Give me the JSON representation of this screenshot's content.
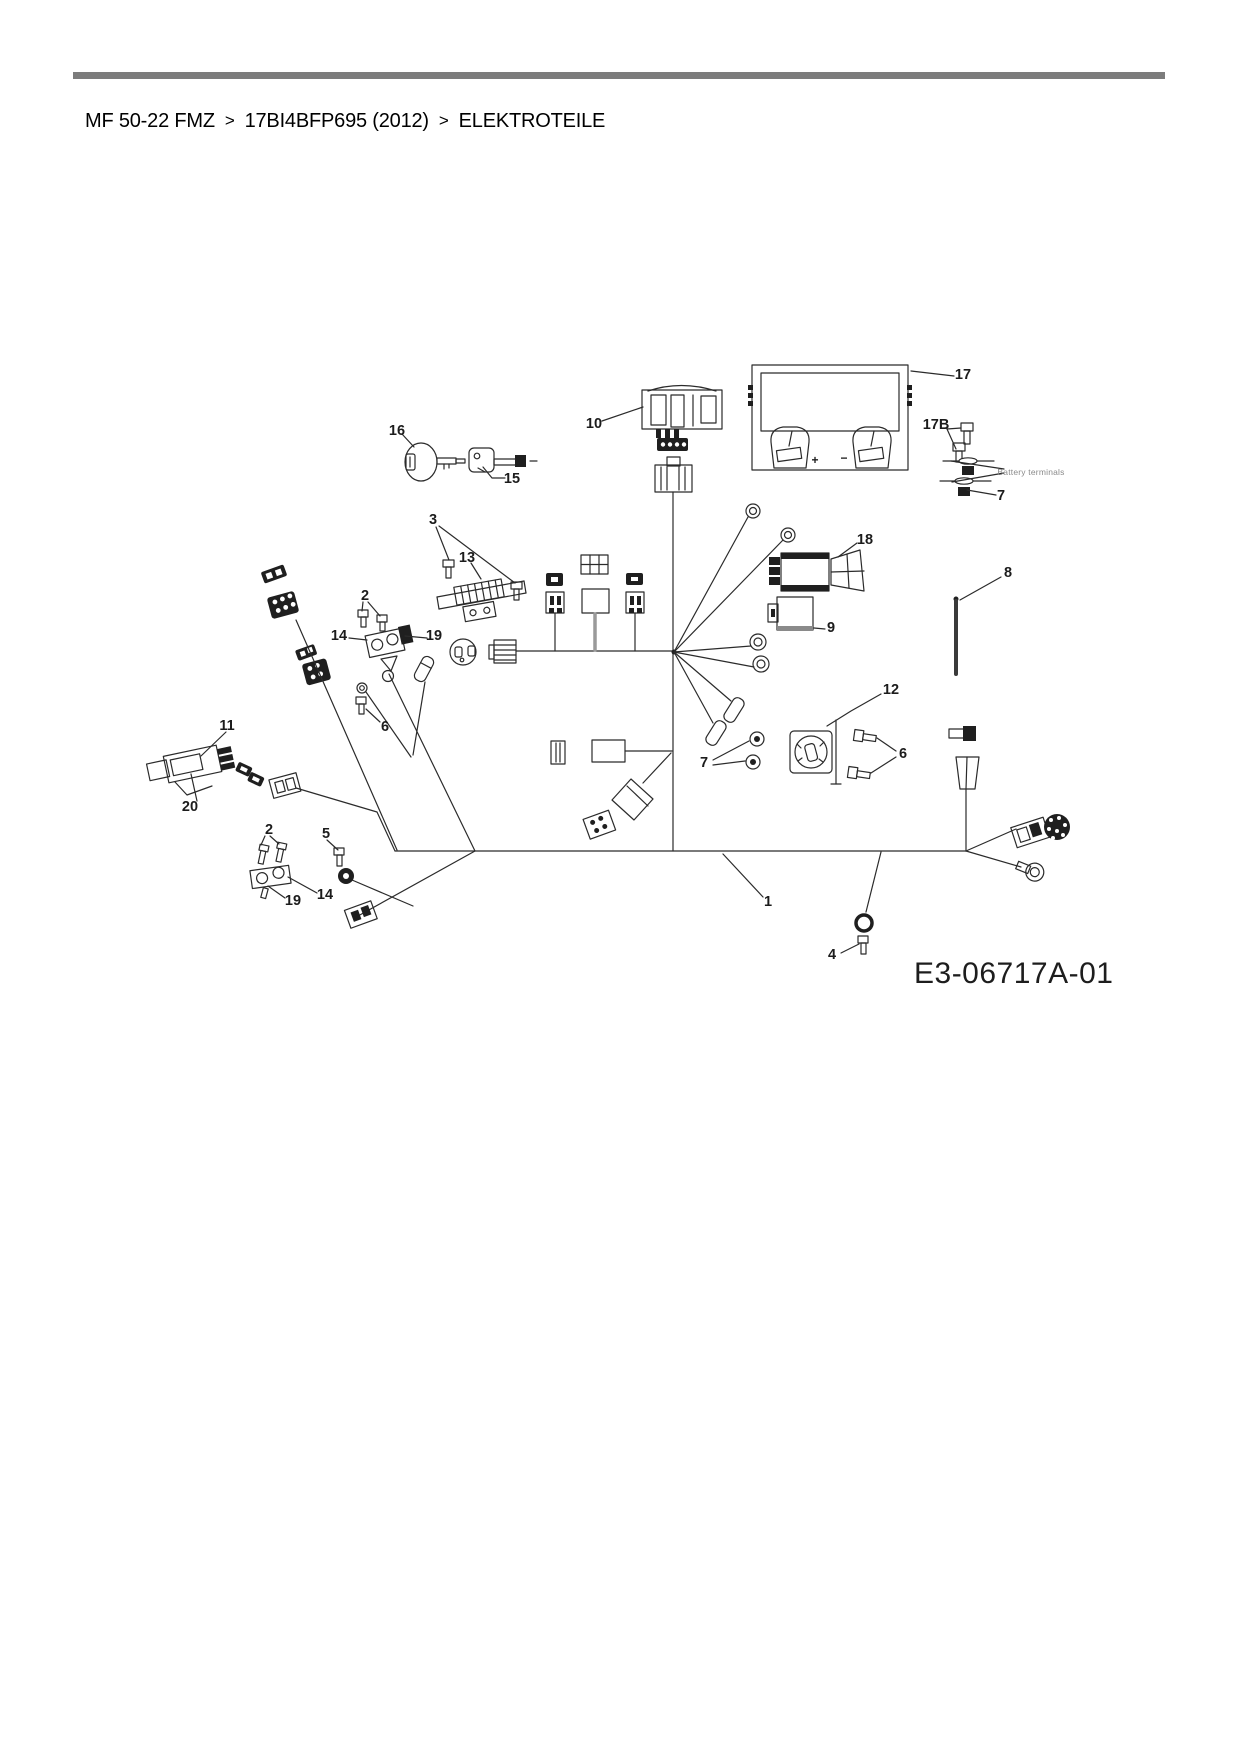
{
  "header": {
    "breadcrumb": {
      "separator": ">",
      "items": [
        "MF 50-22 FMZ",
        "17BI4BFP695 (2012)",
        "ELEKTROTEILE"
      ]
    },
    "rule_color": "#7c7c7c"
  },
  "diagram": {
    "code": "E3-06717A-01",
    "ink_color": "#2b2b2b",
    "label_color": "#1c1c1c",
    "caption_color": "#8a8a8a",
    "labels": [
      {
        "text": "16",
        "x": 397,
        "y": 431
      },
      {
        "text": "15",
        "x": 512,
        "y": 479
      },
      {
        "text": "10",
        "x": 594,
        "y": 424
      },
      {
        "text": "17",
        "x": 963,
        "y": 375
      },
      {
        "text": "17B",
        "x": 936,
        "y": 425
      },
      {
        "text": "Battery terminals",
        "x": 1031,
        "y": 472,
        "cls": "tiny"
      },
      {
        "text": "7",
        "x": 1001,
        "y": 496
      },
      {
        "text": "3",
        "x": 433,
        "y": 520
      },
      {
        "text": "13",
        "x": 467,
        "y": 558
      },
      {
        "text": "2",
        "x": 365,
        "y": 596
      },
      {
        "text": "14",
        "x": 339,
        "y": 636
      },
      {
        "text": "19",
        "x": 434,
        "y": 636
      },
      {
        "text": "6",
        "x": 385,
        "y": 727
      },
      {
        "text": "11",
        "x": 227,
        "y": 726
      },
      {
        "text": "20",
        "x": 190,
        "y": 807
      },
      {
        "text": "18",
        "x": 865,
        "y": 540
      },
      {
        "text": "9",
        "x": 831,
        "y": 628
      },
      {
        "text": "8",
        "x": 1008,
        "y": 573
      },
      {
        "text": "12",
        "x": 891,
        "y": 690
      },
      {
        "text": "6",
        "x": 903,
        "y": 754
      },
      {
        "text": "7",
        "x": 704,
        "y": 763
      },
      {
        "text": "2",
        "x": 269,
        "y": 830
      },
      {
        "text": "5",
        "x": 326,
        "y": 834
      },
      {
        "text": "19",
        "x": 293,
        "y": 901
      },
      {
        "text": "14",
        "x": 325,
        "y": 895
      },
      {
        "text": "1",
        "x": 768,
        "y": 902
      },
      {
        "text": "4",
        "x": 832,
        "y": 955
      },
      {
        "text": "+",
        "x": 815,
        "y": 460,
        "cls": "sym"
      },
      {
        "text": "−",
        "x": 844,
        "y": 458,
        "cls": "sym"
      }
    ]
  }
}
